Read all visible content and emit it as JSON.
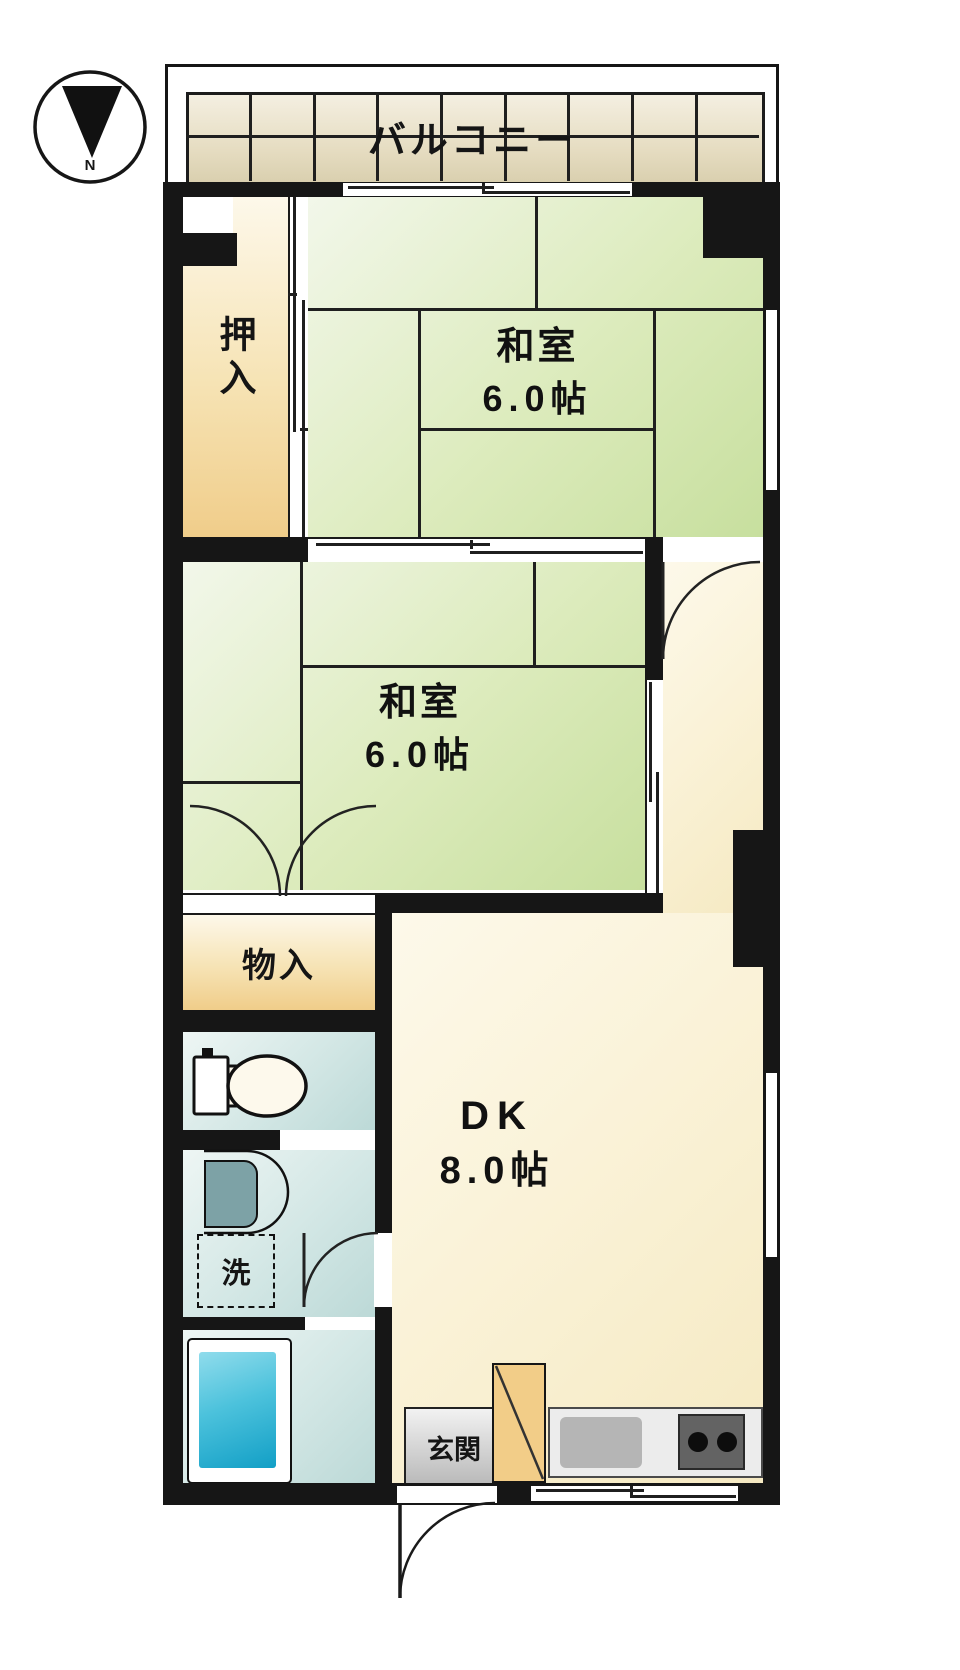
{
  "compass": {
    "north_label": "N"
  },
  "balcony": {
    "label": "バルコニー"
  },
  "rooms": {
    "closet": {
      "label": "押入"
    },
    "tatami_room_1": {
      "name": "和室",
      "size": "6.0帖"
    },
    "tatami_room_2": {
      "name": "和室",
      "size": "6.0帖"
    },
    "storage": {
      "label": "物入"
    },
    "laundry": {
      "label": "洗"
    },
    "dining_kitchen": {
      "name": "DK",
      "size": "8.0帖"
    },
    "entrance": {
      "label": "玄関"
    }
  },
  "colors": {
    "wall": "#161616",
    "tatami_green": "#cfe3a6",
    "closet_beige": "#f0cd8a",
    "water_teal": "#bcd9d7",
    "dk_cream": "#f9f0d2",
    "tub_blue": "#129fc6",
    "entrance_gray": "#c9c9c9",
    "cabinet_tan": "#f2cd88"
  }
}
